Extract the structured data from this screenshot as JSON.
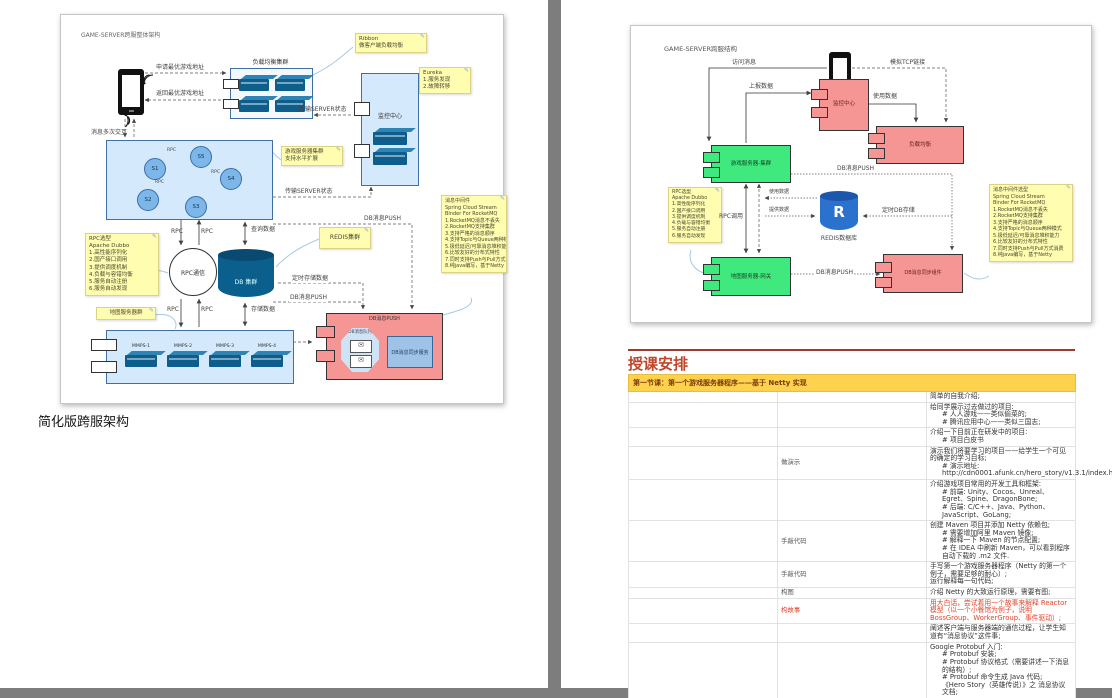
{
  "left_page": {
    "caption": "简化版跨服架构",
    "diagram": {
      "title": "GAME-SERVER跨服整体架构",
      "labels": {
        "request": "申请最优游戏地址",
        "response": "返回最优游戏地址",
        "msg_exchange": "消息多次交互",
        "lb_title": "负载均衡集群",
        "state1": "传输SERVER状态",
        "state2": "传输SERVER状态",
        "monitor": "监控中心",
        "db_push": "DB消息PUSH",
        "db_push2": "DB消息PUSH",
        "rpc": "RPC",
        "rpc_comm": "RPC通信",
        "query": "查询数据",
        "store": "存储数据",
        "timed": "定时存储数据",
        "db": "DB 集群",
        "queue": "DB消息队列",
        "sync": "DB消息同步服务",
        "push_inner": "DB消息PUSH"
      },
      "nodes": [
        "S1",
        "S5",
        "S2",
        "S4",
        "S3"
      ],
      "mmps": [
        "MMPS-1",
        "MMPS-2",
        "MMPS-3",
        "MMPS-4"
      ],
      "notes": {
        "ribbon": [
          "Ribbon",
          "做客户端负载均衡"
        ],
        "eureka": [
          "Eureka",
          "1.服务发现",
          "2.故障转移"
        ],
        "game_server": [
          "游戏服务器集群",
          "支持水平扩展"
        ],
        "redis": [
          "REDIS集群"
        ],
        "rpc": [
          "RPC选型",
          "Apache Dubbo",
          "1.高性能序列化",
          "2.国产接口调用",
          "3.提供调度机制",
          "4.负载与容错均衡",
          "5.服务自动注册",
          "6.服务自动发现"
        ],
        "map_server": [
          "地图服务器群"
        ],
        "mq": [
          "消息中间件",
          "Spring Cloud Stream",
          "Binder For RocketMQ",
          "1.RocketMQ消息不丢失",
          "2.RocketMQ支持集群",
          "3.支持严格的消息顺序",
          "4.支持Topic与Queue两种模式",
          "5.极低延迟/可靠消息堆积能力",
          "6.比较友好的分布式特性",
          "7.同时支持Push与Pull方式消费",
          "8.纯java编写，基于Netty"
        ]
      }
    }
  },
  "right_page": {
    "diagram": {
      "title": "GAME-SERVER跨服结构",
      "labels": {
        "visit": "访问消息",
        "tcp": "模拟TCP链接",
        "report": "上报数据",
        "use1": "使用数据",
        "monitor": "监控中心",
        "lb": "负载均衡",
        "cluster": "游戏服务器-集群",
        "rpc_call": "RPC调用",
        "use2": "使用数据",
        "provide": "提供数据",
        "redis_r": "R",
        "redis_label": "REDIS数据库",
        "timed": "定时DB存储",
        "push_top": "DB消息PUSH",
        "gateway": "地图服务器-网关",
        "push_bottom": "DB消息PUSH",
        "sync": "DB消息同步组件"
      },
      "notes": {
        "rpc": [
          "RPC选型",
          "Apache Dubbo",
          "1.高性能序列化",
          "2.国产接口调用",
          "3.提供调度机制",
          "4.负载与容错均衡",
          "5.服务自动注册",
          "6.服务自动发现"
        ],
        "mq": [
          "消息中间件选型",
          "Spring Cloud Stream",
          "Binder For RocketMQ",
          "1.RocketMQ消息不丢失",
          "2.RocketMQ支持集群",
          "3.支持严格的消息顺序",
          "4.支持Topic与Queue两种模式",
          "5.极低延迟/可靠消息堆积能力",
          "6.比较友好的分布式特性",
          "7.同时支持Push与Pull方式消费",
          "8.纯java编写，基于Netty"
        ]
      }
    },
    "schedule": {
      "heading": "授课安排",
      "header": "第一节课：第一个游戏服务器程序——基于 Netty 实现",
      "rows": [
        {
          "label": "",
          "lines": [
            "简单的自我介绍;"
          ]
        },
        {
          "label": "",
          "lines": [
            "给同学展示过去做过的项目:",
            "# 人人游戏——类似偷菜的;",
            "# 腾讯应用中心——类似三国志;"
          ]
        },
        {
          "label": "",
          "lines": [
            "介绍一下目前正在研发中的项目:",
            "# 项目白皮书"
          ]
        },
        {
          "label": "做演示",
          "lines": [
            "演示我们将要学习的项目——给学生一个可见的确定的学习目标;",
            "# 演示地址: http://cdn0001.afunk.cn/hero_story/v1.3.1/index.html"
          ]
        },
        {
          "label": "",
          "lines": [
            "介绍游戏项目常用的开发工具和框架:",
            "# 前端: Unity、Cocos、Unreal、Egret、Spine、DragonBone;",
            "# 后端: C/C++、Java、Python、JavaScript、GoLang;"
          ]
        },
        {
          "label": "手敲代码",
          "lines": [
            "创建 Maven 项目并添加 Netty 依赖包;",
            "# 需要增加阿里 Maven 镜像;",
            "# 解释一下 Maven 的节点配置;",
            "# 在 IDEA 中刷新 Maven，可以看到程序自动下载的 .m2 文件."
          ]
        },
        {
          "label": "手敲代码",
          "lines": [
            "手写第一个游戏服务器程序（Netty 的第一个例子，需要足够的耐心）;",
            "运行解释每一句代码;"
          ]
        },
        {
          "label": "构图",
          "lines": [
            "介绍 Netty 的大致运行原理，需要有图;"
          ]
        },
        {
          "label": "构故事",
          "red": true,
          "lines": [
            "用大白话，尝试着用一个故事来解释 Reactor 模型（以一个小餐馆为例子，说明 BossGroup、WorkerGroup、事件驱动）;"
          ]
        },
        {
          "label": "",
          "lines": [
            "阐述客户端与服务器端的通信过程，让学生知道有“消息协议”这件事;"
          ]
        },
        {
          "label": "",
          "lines": [
            "Google Protobuf 入门:",
            "# Protobuf 安装;",
            "# Protobuf 协议格式（需要讲述一下消息的结构）;",
            "# Protobuf 命令生成 Java 代码;",
            "《Hero Story（英雄传说）》之 消息协议文档;"
          ]
        },
        {
          "label": "手敲命令行",
          "lines": [
            "生成 Java 代码;"
          ]
        },
        {
          "label": "手敲代码",
          "lines": [
            "增加解码器;"
          ]
        },
        {
          "label": "",
          "lines": [
            "拦截 UserEntryCmd 指令，打印用户信息;"
          ]
        }
      ]
    }
  }
}
